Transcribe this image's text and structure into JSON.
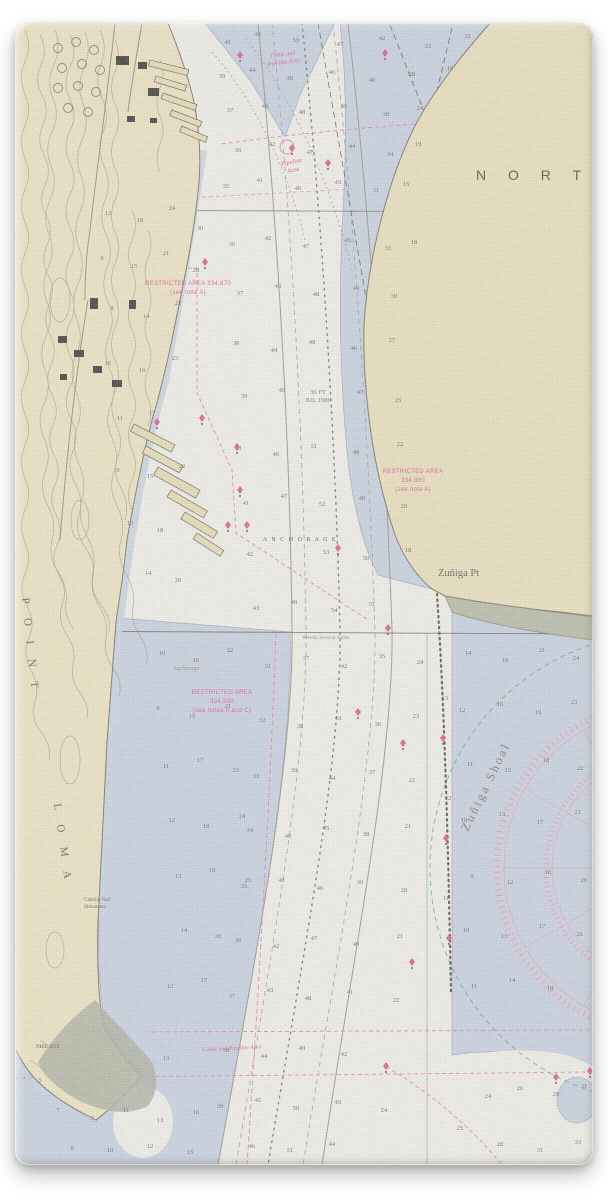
{
  "product": {
    "title": "San Diego harbor entrance nautical chart print"
  },
  "colors": {
    "magenta": "#da4f97",
    "compass_pink": "#ec96bb",
    "shallow_blue": "#c6d0e2",
    "land_tan": "#ede3c1",
    "north_island_tan": "#e9dfba",
    "foreshore_gray": "#b3b6a3",
    "green": "#2f9e62",
    "contour_gray": "#8f8b79"
  },
  "labels": {
    "north_island": "N O R T H",
    "point": "P O I N T",
    "loma": "L O M A",
    "zuniga_pt": "Zuñiga Pt",
    "zuniga_shoal": "Zuñiga Shoal",
    "restricted_a_1": "RESTRICTED AREA 334.870",
    "restricted_a_2": "(see note A)",
    "restricted_b_1": "RESTRICTED AREA",
    "restricted_b_2": "334.880",
    "restricted_b_3": "(see notes A and C)",
    "restricted_c_1": "RESTRICTED AREA",
    "restricted_c_2": "334.860",
    "restricted_c_3": "(see note A)",
    "pipeline_area_1": "Pipeline",
    "pipeline_area_2": "Area",
    "cable_area_top_1": "Cable and",
    "cable_area_top_2": "Pipeline Area",
    "cable_area_bottom": "Cable and Pipeline Area",
    "channel_note_1": "36 FT",
    "channel_note_2": "JUL 1986",
    "anchorage_caps": "A N C H O R A G E",
    "anchorage_italic": "Anchorage",
    "wrecks": "Wrecks Several Subm",
    "monument_1": "Cabrillo Natl",
    "monument_2": "Monument",
    "nike_site": "NIKE SITE"
  },
  "soundings": [
    [
      228,
      44,
      "41"
    ],
    [
      258,
      36,
      "45"
    ],
    [
      296,
      42,
      "50"
    ],
    [
      340,
      46,
      "47"
    ],
    [
      382,
      40,
      "42"
    ],
    [
      428,
      48,
      "33"
    ],
    [
      468,
      38,
      "21"
    ],
    [
      222,
      78,
      "39"
    ],
    [
      252,
      72,
      "44"
    ],
    [
      290,
      80,
      "49"
    ],
    [
      332,
      74,
      "46"
    ],
    [
      372,
      82,
      "40"
    ],
    [
      412,
      76,
      "28"
    ],
    [
      450,
      70,
      "16"
    ],
    [
      230,
      112,
      "37"
    ],
    [
      265,
      108,
      "43"
    ],
    [
      302,
      114,
      "48"
    ],
    [
      344,
      108,
      "45"
    ],
    [
      386,
      116,
      "38"
    ],
    [
      420,
      110,
      "24"
    ],
    [
      238,
      152,
      "36"
    ],
    [
      272,
      146,
      "42"
    ],
    [
      310,
      154,
      "47"
    ],
    [
      352,
      148,
      "44"
    ],
    [
      390,
      156,
      "34"
    ],
    [
      418,
      146,
      "19"
    ],
    [
      226,
      188,
      "35"
    ],
    [
      260,
      182,
      "41"
    ],
    [
      298,
      190,
      "46"
    ],
    [
      338,
      184,
      "43"
    ],
    [
      376,
      192,
      "31"
    ],
    [
      406,
      186,
      "15"
    ],
    [
      108,
      215,
      "12"
    ],
    [
      140,
      222,
      "18"
    ],
    [
      172,
      210,
      "24"
    ],
    [
      200,
      230,
      "30"
    ],
    [
      102,
      260,
      "9"
    ],
    [
      134,
      268,
      "15"
    ],
    [
      166,
      255,
      "21"
    ],
    [
      196,
      272,
      "28"
    ],
    [
      112,
      310,
      "8"
    ],
    [
      146,
      318,
      "14"
    ],
    [
      178,
      305,
      "22"
    ],
    [
      108,
      365,
      "10"
    ],
    [
      142,
      372,
      "16"
    ],
    [
      175,
      360,
      "23"
    ],
    [
      120,
      420,
      "11"
    ],
    [
      152,
      415,
      "17"
    ],
    [
      118,
      472,
      "9"
    ],
    [
      150,
      478,
      "15"
    ],
    [
      182,
      468,
      "22"
    ],
    [
      130,
      525,
      "12"
    ],
    [
      160,
      532,
      "18"
    ],
    [
      148,
      575,
      "14"
    ],
    [
      178,
      582,
      "20"
    ],
    [
      232,
      246,
      "36"
    ],
    [
      268,
      240,
      "42"
    ],
    [
      306,
      248,
      "47"
    ],
    [
      348,
      242,
      "45"
    ],
    [
      388,
      250,
      "33"
    ],
    [
      414,
      244,
      "18"
    ],
    [
      240,
      295,
      "37"
    ],
    [
      278,
      288,
      "43"
    ],
    [
      316,
      296,
      "48"
    ],
    [
      356,
      290,
      "44"
    ],
    [
      394,
      298,
      "30"
    ],
    [
      236,
      345,
      "38"
    ],
    [
      274,
      352,
      "44"
    ],
    [
      312,
      344,
      "49"
    ],
    [
      354,
      350,
      "46"
    ],
    [
      392,
      342,
      "27"
    ],
    [
      244,
      398,
      "39"
    ],
    [
      282,
      392,
      "45"
    ],
    [
      360,
      394,
      "47"
    ],
    [
      398,
      402,
      "25"
    ],
    [
      238,
      450,
      "40"
    ],
    [
      276,
      456,
      "46"
    ],
    [
      314,
      448,
      "51"
    ],
    [
      356,
      454,
      "48"
    ],
    [
      400,
      446,
      "22"
    ],
    [
      246,
      505,
      "41"
    ],
    [
      284,
      498,
      "47"
    ],
    [
      322,
      506,
      "52"
    ],
    [
      362,
      500,
      "49"
    ],
    [
      404,
      508,
      "20"
    ],
    [
      250,
      556,
      "42"
    ],
    [
      326,
      554,
      "53"
    ],
    [
      366,
      560,
      "50"
    ],
    [
      408,
      552,
      "18"
    ],
    [
      256,
      610,
      "43"
    ],
    [
      294,
      604,
      "49"
    ],
    [
      334,
      612,
      "54"
    ],
    [
      372,
      606,
      "51"
    ],
    [
      162,
      655,
      "10"
    ],
    [
      196,
      662,
      "16"
    ],
    [
      230,
      652,
      "22"
    ],
    [
      158,
      710,
      "9"
    ],
    [
      192,
      718,
      "15"
    ],
    [
      228,
      708,
      "21"
    ],
    [
      166,
      768,
      "11"
    ],
    [
      200,
      762,
      "17"
    ],
    [
      236,
      772,
      "23"
    ],
    [
      172,
      822,
      "12"
    ],
    [
      206,
      828,
      "18"
    ],
    [
      242,
      818,
      "24"
    ],
    [
      178,
      878,
      "13"
    ],
    [
      212,
      872,
      "19"
    ],
    [
      248,
      882,
      "25"
    ],
    [
      184,
      932,
      "14"
    ],
    [
      218,
      938,
      "20"
    ],
    [
      170,
      988,
      "12"
    ],
    [
      204,
      982,
      "17"
    ],
    [
      268,
      668,
      "31"
    ],
    [
      306,
      660,
      "37"
    ],
    [
      344,
      668,
      "42"
    ],
    [
      382,
      658,
      "35"
    ],
    [
      420,
      664,
      "24"
    ],
    [
      262,
      722,
      "32"
    ],
    [
      300,
      728,
      "38"
    ],
    [
      338,
      720,
      "43"
    ],
    [
      378,
      726,
      "36"
    ],
    [
      416,
      718,
      "23"
    ],
    [
      256,
      778,
      "33"
    ],
    [
      294,
      772,
      "39"
    ],
    [
      332,
      780,
      "44"
    ],
    [
      372,
      774,
      "37"
    ],
    [
      412,
      782,
      "22"
    ],
    [
      250,
      832,
      "34"
    ],
    [
      288,
      838,
      "40"
    ],
    [
      326,
      830,
      "45"
    ],
    [
      366,
      836,
      "38"
    ],
    [
      408,
      828,
      "21"
    ],
    [
      244,
      888,
      "35"
    ],
    [
      282,
      882,
      "41"
    ],
    [
      320,
      890,
      "46"
    ],
    [
      360,
      884,
      "39"
    ],
    [
      404,
      892,
      "20"
    ],
    [
      238,
      942,
      "36"
    ],
    [
      276,
      948,
      "42"
    ],
    [
      314,
      940,
      "47"
    ],
    [
      356,
      946,
      "40"
    ],
    [
      400,
      938,
      "21"
    ],
    [
      232,
      998,
      "37"
    ],
    [
      270,
      992,
      "43"
    ],
    [
      308,
      1000,
      "48"
    ],
    [
      350,
      994,
      "41"
    ],
    [
      396,
      1002,
      "22"
    ],
    [
      226,
      1052,
      "38"
    ],
    [
      264,
      1058,
      "44"
    ],
    [
      302,
      1050,
      "49"
    ],
    [
      344,
      1056,
      "42"
    ],
    [
      220,
      1108,
      "39"
    ],
    [
      258,
      1102,
      "45"
    ],
    [
      296,
      1110,
      "50"
    ],
    [
      338,
      1104,
      "43"
    ],
    [
      384,
      1112,
      "24"
    ],
    [
      252,
      1148,
      "46"
    ],
    [
      290,
      1152,
      "51"
    ],
    [
      332,
      1146,
      "44"
    ],
    [
      468,
      655,
      "14"
    ],
    [
      505,
      662,
      "18"
    ],
    [
      542,
      652,
      "21"
    ],
    [
      576,
      660,
      "24"
    ],
    [
      462,
      712,
      "12"
    ],
    [
      500,
      706,
      "16"
    ],
    [
      538,
      714,
      "19"
    ],
    [
      574,
      704,
      "23"
    ],
    [
      470,
      766,
      "11"
    ],
    [
      508,
      772,
      "15"
    ],
    [
      546,
      762,
      "18"
    ],
    [
      580,
      770,
      "22"
    ],
    [
      464,
      822,
      "10"
    ],
    [
      502,
      816,
      "13"
    ],
    [
      540,
      824,
      "17"
    ],
    [
      578,
      814,
      "21"
    ],
    [
      472,
      878,
      "9"
    ],
    [
      510,
      884,
      "12"
    ],
    [
      548,
      874,
      "16"
    ],
    [
      584,
      882,
      "20"
    ],
    [
      466,
      932,
      "10"
    ],
    [
      504,
      938,
      "13"
    ],
    [
      542,
      928,
      "17"
    ],
    [
      580,
      936,
      "21"
    ],
    [
      474,
      988,
      "11"
    ],
    [
      512,
      982,
      "14"
    ],
    [
      550,
      990,
      "18"
    ],
    [
      445,
      700,
      "13"
    ],
    [
      448,
      800,
      "12"
    ],
    [
      446,
      900,
      "11"
    ],
    [
      520,
      1090,
      "26"
    ],
    [
      556,
      1096,
      "29"
    ],
    [
      584,
      1088,
      "31"
    ],
    [
      488,
      1098,
      "24"
    ],
    [
      500,
      1146,
      "28"
    ],
    [
      540,
      1152,
      "31"
    ],
    [
      578,
      1144,
      "33"
    ],
    [
      460,
      1130,
      "25"
    ],
    [
      58,
      1112,
      "7"
    ],
    [
      92,
      1120,
      "9"
    ],
    [
      126,
      1112,
      "11"
    ],
    [
      160,
      1122,
      "13"
    ],
    [
      196,
      1114,
      "16"
    ],
    [
      72,
      1150,
      "8"
    ],
    [
      110,
      1152,
      "10"
    ],
    [
      150,
      1148,
      "12"
    ],
    [
      190,
      1154,
      "15"
    ],
    [
      40,
      1082,
      "5"
    ],
    [
      166,
      1060,
      "13"
    ]
  ],
  "buoys": [
    [
      240,
      55
    ],
    [
      385,
      53
    ],
    [
      292,
      148
    ],
    [
      328,
      163
    ],
    [
      205,
      262
    ],
    [
      157,
      422
    ],
    [
      202,
      418
    ],
    [
      237,
      447
    ],
    [
      240,
      490
    ],
    [
      228,
      525
    ],
    [
      247,
      525
    ],
    [
      338,
      548
    ],
    [
      388,
      628
    ],
    [
      358,
      712
    ],
    [
      403,
      743
    ],
    [
      443,
      738
    ],
    [
      446,
      838
    ],
    [
      449,
      938
    ],
    [
      386,
      1066
    ],
    [
      556,
      1077
    ],
    [
      590,
      1071
    ],
    [
      412,
      962
    ]
  ]
}
